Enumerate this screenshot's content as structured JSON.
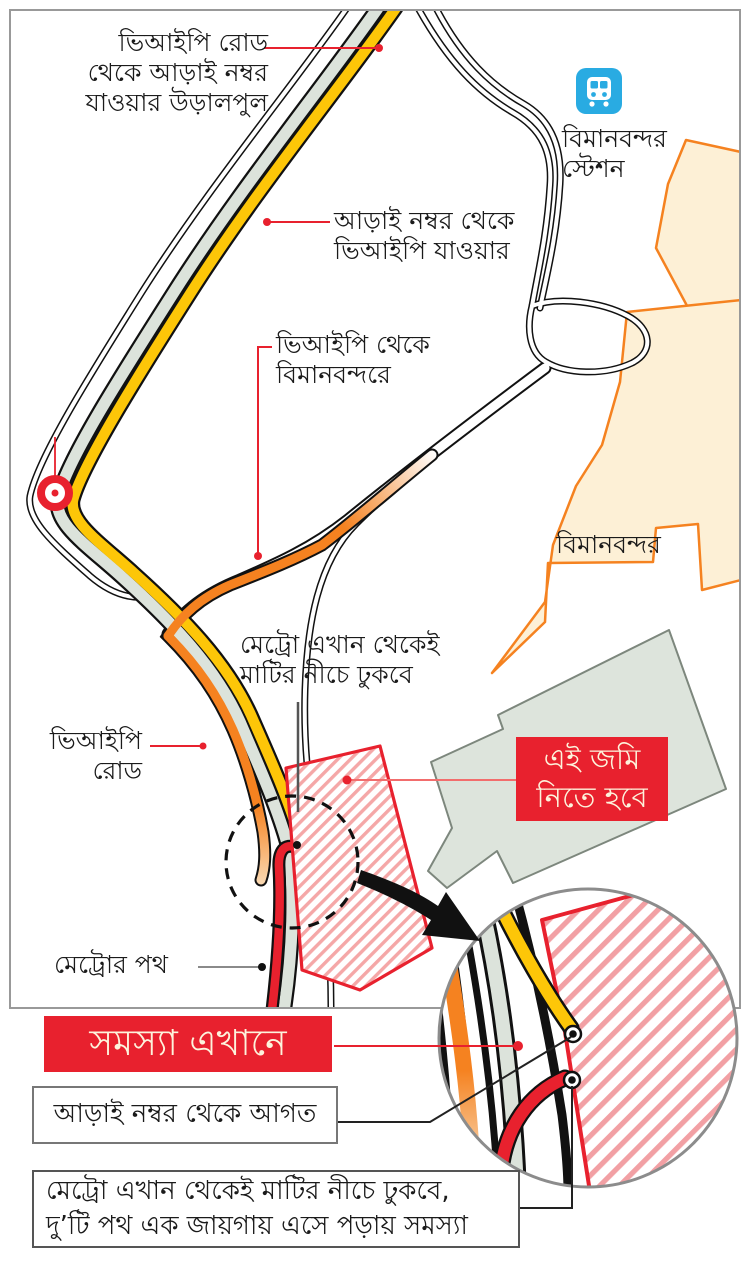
{
  "map": {
    "labels": {
      "flyover": "ভিআইপি রোড\nথেকে আড়াই নম্বর\nযাওয়ার উড়ালপুল",
      "station": "বিমানবন্দর\nস্টেশন",
      "arai_to_vip": "আড়াই নম্বর থেকে\nভিআইপি যাওয়ার",
      "vip_to_airport": "ভিআইপি থেকে\nবিমানবন্দরে",
      "airport": "বিমানবন্দর",
      "metro_underground": "মেট্রো এখান থেকেই\nমাটির নীচে ঢুকবে",
      "vip_road": "ভিআইপি\nরোড",
      "metro_path": "মেট্রোর পথ"
    },
    "callouts": {
      "land_needed": "এই জমি\nনিতে হবে",
      "problem_here": "সমস্যা এখানে",
      "from_arai": "আড়াই নম্বর থেকে আগত",
      "bottom_note": "মেট্রো এখান থেকেই মাটির নীচে ঢুকবে,\nদু’টি পথ এক জায়গায় এসে পড়ায় সমস্যা"
    },
    "icons": {
      "train": "train-icon"
    },
    "colors": {
      "callout_red": "#e8212e",
      "metro_red": "#e8212e",
      "flyover_yellow": "#fdc608",
      "airport_road_orange": "#f58220",
      "road_gray": "#dce3db",
      "area_gray": "#dde4dc",
      "airport_fill": "#fdf0d6",
      "airport_border": "#f58220",
      "train_icon_blue": "#29abe2",
      "hatch_pink": "#f5a7a7",
      "frame_gray": "#999999",
      "callout_text_cream": "#fdf3dc"
    }
  }
}
